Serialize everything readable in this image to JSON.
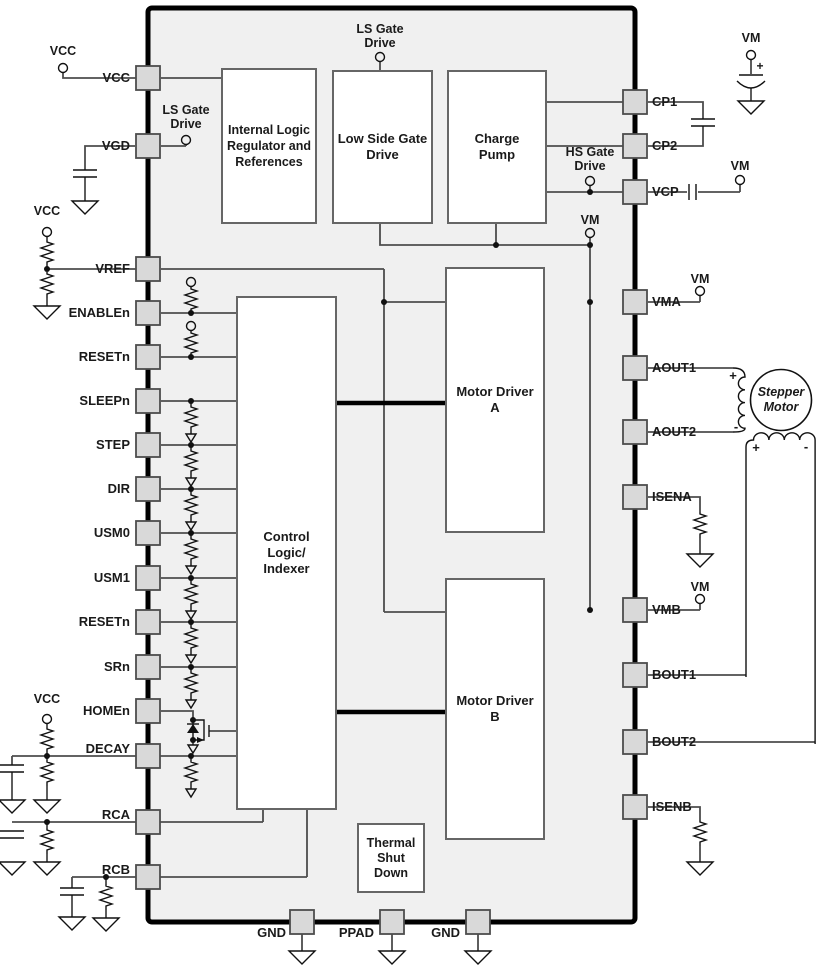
{
  "diagram": {
    "title": "Stepper motor driver functional block diagram",
    "blocks": {
      "internal_logic_regulator": "Internal Logic\nRegulator and\nReferences",
      "low_side_gate_drive": "Low Side Gate\nDrive",
      "charge_pump": "Charge\nPump",
      "motor_driver_a": "Motor Driver\nA",
      "motor_driver_b": "Motor Driver\nB",
      "control_logic_indexer": "Control\nLogic/\nIndexer",
      "thermal_shutdown": "Thermal\nShut\nDown"
    },
    "pins": {
      "left": [
        "VCC",
        "VGD",
        "VREF",
        "ENABLEn",
        "RESETn",
        "SLEEPn",
        "STEP",
        "DIR",
        "USM0",
        "USM1",
        "RESETn",
        "SRn",
        "HOMEn",
        "DECAY",
        "RCA",
        "RCB"
      ],
      "right": [
        "CP1",
        "CP2",
        "VCP",
        "VMA",
        "AOUT1",
        "AOUT2",
        "ISENA",
        "VMB",
        "BOUT1",
        "BOUT2",
        "ISENB"
      ],
      "bottom": [
        "GND",
        "PPAD",
        "GND"
      ]
    },
    "terminals": {
      "vcc": "VCC",
      "vm": "VM",
      "ls_gate_drive": "LS Gate\nDrive",
      "hs_gate_drive": "HS Gate\nDrive"
    },
    "motor_label": "Stepper\nMotor",
    "polarity": {
      "plus": "+",
      "minus": "-"
    },
    "colors": {
      "chip_fill": "#f0f0f0",
      "chip_border": "#000000",
      "block_border": "#666666",
      "wire": "#4d4d4d",
      "symbol": "#111111",
      "pin_fill": "#d9d9d9",
      "bus": "#000000"
    }
  }
}
